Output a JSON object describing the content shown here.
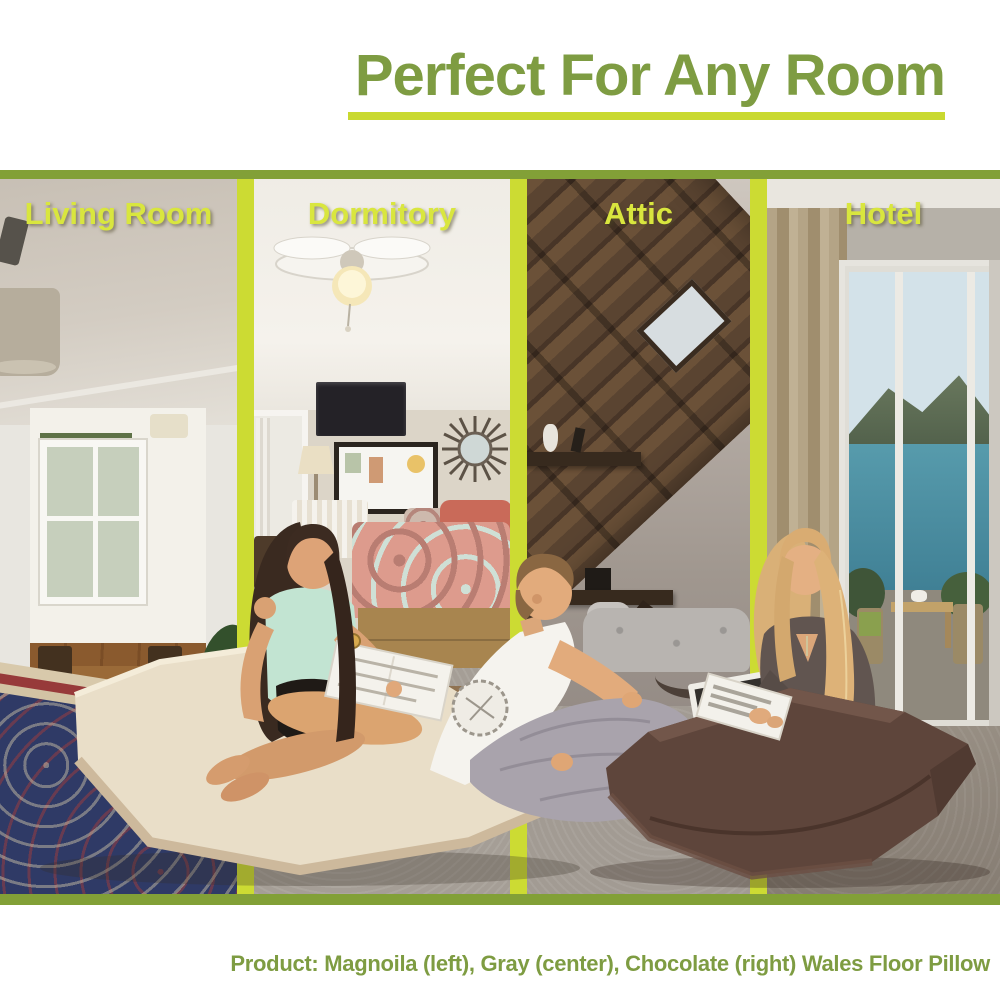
{
  "header": {
    "title": "Perfect For Any Room"
  },
  "collage": {
    "sections": [
      {
        "label": "Living Room"
      },
      {
        "label": "Dormitory"
      },
      {
        "label": "Attic"
      },
      {
        "label": "Hotel"
      }
    ]
  },
  "footer": {
    "caption": "Product: Magnoila (left), Gray (center), Chocolate (right) Wales Floor Pillow"
  },
  "products": [
    {
      "name": "Magnoila",
      "position": "left"
    },
    {
      "name": "Gray",
      "position": "center"
    },
    {
      "name": "Chocolate",
      "position": "right"
    }
  ],
  "product_line": "Wales Floor Pillow",
  "colors": {
    "title_green": "#7e9c42",
    "divider_yellow_green": "#ccdb33",
    "underline_yellow_green": "#c9d930",
    "border_olive": "#82a037",
    "label_yellow": "#d9e63e",
    "pillow_magnolia": "#e9dec8",
    "pillow_gray": "#a9a3ac",
    "pillow_chocolate": "#5e453b"
  }
}
